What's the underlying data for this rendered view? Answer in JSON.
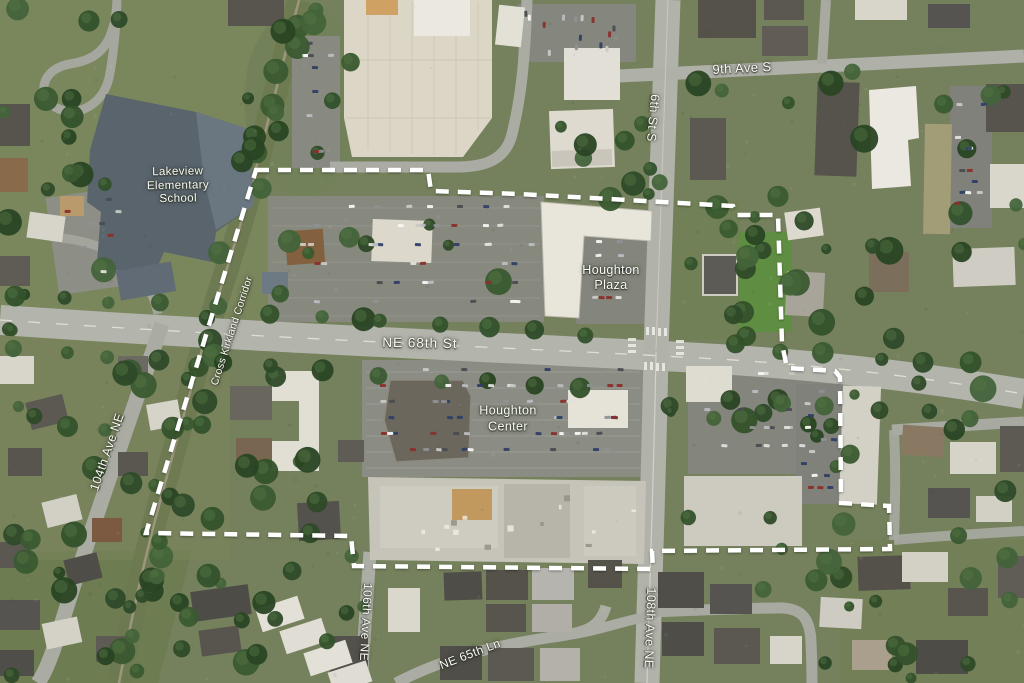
{
  "labels": {
    "school": {
      "line1": "Lakeview",
      "line2": "Elementary",
      "line3": "School"
    },
    "plaza": {
      "line1": "Houghton",
      "line2": "Plaza"
    },
    "center": {
      "line1": "Houghton",
      "line2": "Center"
    },
    "street_9th": "9th Ave S",
    "street_6th": "6th St S",
    "street_68th": "NE 68th St",
    "street_104th": "104th Ave NE",
    "corridor": "Cross Kirkland Corridor",
    "street_106th": "106th Ave NE",
    "street_108th": "108th Ave NE",
    "street_65th": "NE 65th Ln"
  },
  "boundary": {
    "points": "256,170 428,170 431,191 520,194 733,206 737,215 778,215 782,344 787,368 835,371 840,377 841,503 889,506 890,549 652,551 653,569 354,566 351,536 146,533",
    "color": "#ffffff",
    "style": "dashed"
  },
  "palette": {
    "grass": "#75815c",
    "tree_green": "#33502c",
    "road_gray": "#b3b5ad",
    "parking_gray": "#8a8c84",
    "building_light": "#e7e4da",
    "building_dark": "#55534d",
    "school_roof": "#59646d",
    "boundary_white": "#ffffff",
    "label_text": "#fbfbf4"
  }
}
